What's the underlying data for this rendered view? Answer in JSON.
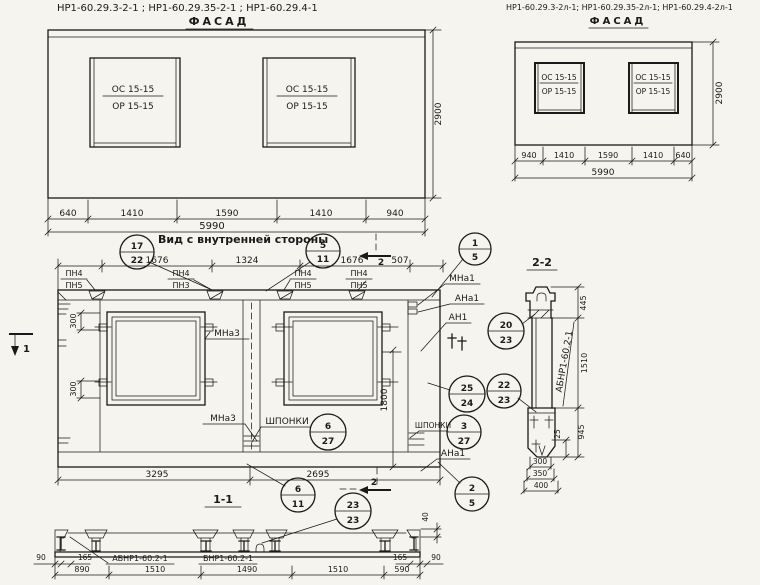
{
  "titles": {
    "top_left_codes": "НР1-60.29.3-2-1 ;  НР1-60.29.35-2-1 ;  НР1-60.29.4-1",
    "top_left_view": "ФАСАД",
    "top_right_codes": "НР1-60.29.3-2л-1; НР1-60.29.35-2л-1; НР1-60.29.4-2л-1",
    "top_right_view": "ФАСАД",
    "inner_view": "Вид с внутренней стороны",
    "section_11": "1-1",
    "section_22": "2-2"
  },
  "facade_left": {
    "window_mark_top": "ОС 15-15",
    "window_mark_bottom": "ОР 15-15",
    "dims": [
      "640",
      "1410",
      "1590",
      "1410",
      "940"
    ],
    "total": "5990",
    "height": "2900"
  },
  "facade_right": {
    "window_mark_top": "ОС 15-15",
    "window_mark_bottom": "ОР 15-15",
    "dims": [
      "940",
      "1410",
      "1590",
      "1410",
      "640"
    ],
    "total": "5990",
    "height": "2900"
  },
  "inner_view": {
    "top_dims": [
      "1676",
      "1324",
      "1676",
      "507"
    ],
    "pn_marks": [
      {
        "top": "ПН4",
        "bottom": "ПН5"
      },
      {
        "top": "ПН4",
        "bottom": "ПН3"
      },
      {
        "top": "ПН4",
        "bottom": "ПН5"
      },
      {
        "top": "ПН4",
        "bottom": "ПН5"
      }
    ],
    "dim_300_top": "300",
    "dim_300_bottom": "300",
    "dim_1800": "1800",
    "bottom_dims": [
      "3295",
      "2695"
    ],
    "mark_mna3_left": "МНа3",
    "mark_mna3_right": "МНа3",
    "keys_label_left": "ШПОНКИ",
    "keys_label_right": "ШПОНКИ",
    "mark_mna1": "МНа1",
    "mark_ana1_top": "АНа1",
    "mark_an1": "АН1",
    "mark_ana1_bottom": "АНа1",
    "cut_mark_1": "1",
    "cut_mark_2_top": "2",
    "cut_mark_2_bottom": "2"
  },
  "balloons": {
    "b17_22": {
      "top": "17",
      "bottom": "22"
    },
    "b5_11": {
      "top": "5",
      "bottom": "11"
    },
    "b1_5": {
      "top": "1",
      "bottom": "5"
    },
    "b20_23": {
      "top": "20",
      "bottom": "23"
    },
    "b25_24": {
      "top": "25",
      "bottom": "24"
    },
    "b22_23": {
      "top": "22",
      "bottom": "23"
    },
    "b3_27": {
      "top": "3",
      "bottom": "27"
    },
    "b6_27": {
      "top": "6",
      "bottom": "27"
    },
    "b6_11": {
      "top": "6",
      "bottom": "11"
    },
    "b23_23": {
      "top": "23",
      "bottom": "23"
    },
    "b2_5": {
      "top": "2",
      "bottom": "5"
    }
  },
  "section_11": {
    "mark_a": "АБНР1-60.2-1",
    "mark_b": "БНР1-60.2-1",
    "dims_left": [
      "90",
      "165"
    ],
    "dims_right": [
      "165",
      "90"
    ],
    "dims_main": [
      "890",
      "1510",
      "1490",
      "1510",
      "590"
    ],
    "dim_40": "40"
  },
  "section_22": {
    "mark": "АБНР1-60.2-1",
    "dim_445": "445",
    "dim_1510": "1510",
    "dim_945": "945",
    "dim_25": "25",
    "dims_bottom": [
      "300",
      "350",
      "400"
    ]
  }
}
